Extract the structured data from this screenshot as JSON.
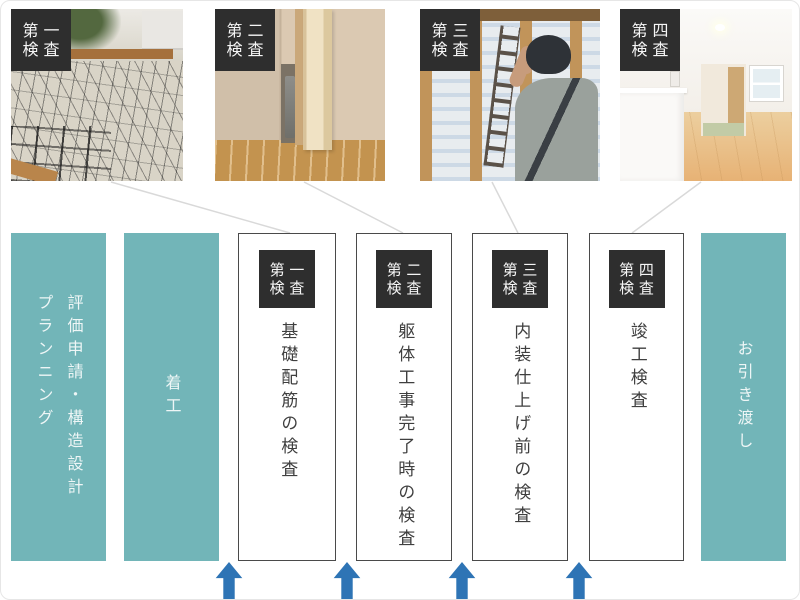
{
  "colors": {
    "teal": "#72b5b8",
    "badge_bg": "#2e2e2e",
    "badge_text": "#f5f5f5",
    "inspection_border": "#4a4a4a",
    "inspection_text": "#3f3f3f",
    "phase_text": "#eef6f6",
    "arrow": "#2e74b5",
    "connector": "#d9d9d9",
    "page_bg": "#ffffff",
    "page_border": "#e6e6e6"
  },
  "photos": [
    {
      "badge": {
        "row1": "第 一",
        "row2": "検 査"
      }
    },
    {
      "badge": {
        "row1": "第 二",
        "row2": "検 査"
      }
    },
    {
      "badge": {
        "row1": "第 三",
        "row2": "検 査"
      }
    },
    {
      "badge": {
        "row1": "第 四",
        "row2": "検 査"
      }
    }
  ],
  "flow": {
    "stages": [
      {
        "kind": "phase",
        "lines": [
          "評価申請・構造設計",
          "プランニング"
        ]
      },
      {
        "kind": "phase",
        "lines": [
          "着工"
        ]
      },
      {
        "kind": "inspection",
        "badge": {
          "row1": "第 一",
          "row2": "検 査"
        },
        "label": "基礎配筋の検査"
      },
      {
        "kind": "inspection",
        "badge": {
          "row1": "第 二",
          "row2": "検 査"
        },
        "label": "躯体工事完了時の検査"
      },
      {
        "kind": "inspection",
        "badge": {
          "row1": "第 三",
          "row2": "検 査"
        },
        "label": "内装仕上げ前の検査"
      },
      {
        "kind": "inspection",
        "badge": {
          "row1": "第 四",
          "row2": "検 査"
        },
        "label": "竣工検査"
      },
      {
        "kind": "phase",
        "lines": [
          "お引き渡し"
        ]
      }
    ]
  },
  "arrows": {
    "count": 4,
    "direction": "up"
  }
}
